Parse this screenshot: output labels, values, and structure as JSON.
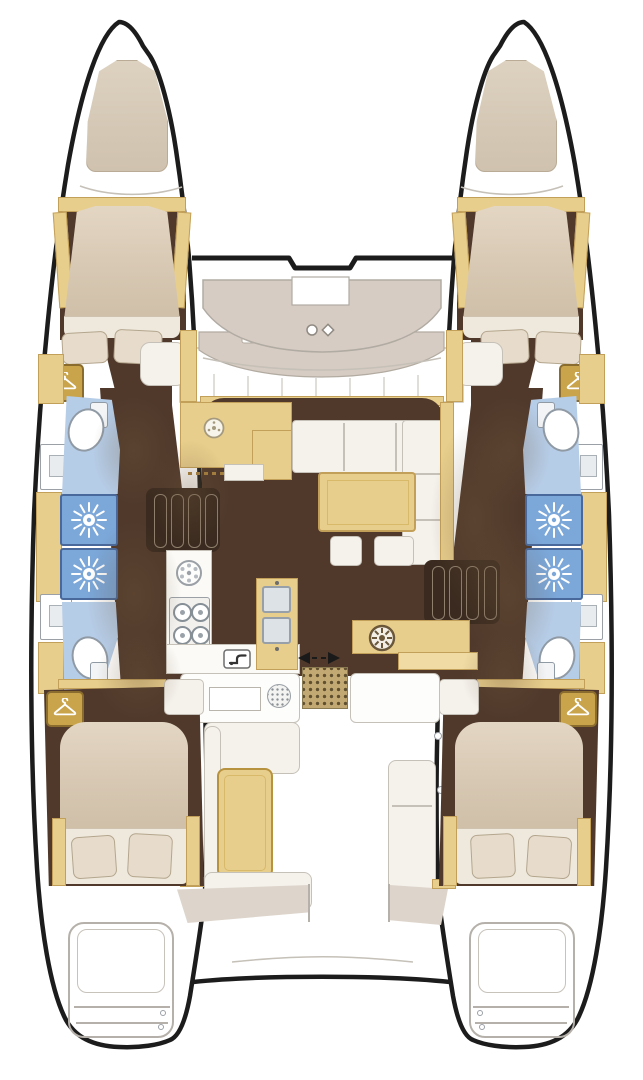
{
  "colors": {
    "bgWhite": "#ffffff",
    "outline": "#1c1c1c",
    "yellow": "#e8ce8c",
    "yellowBorder": "#c2a05a",
    "yellowLight": "#f0dba4",
    "wood": "#50392b",
    "woodDark": "#3a2a1f",
    "blueFloor": "#b6cde8",
    "showerBlue": "#7ba7d9",
    "showerBorder": "#49699c",
    "bedBeige": "#d7c8b3",
    "bedSheet": "#efe9dd",
    "pillow": "#e7dccb",
    "pillowBorder": "#b4a68e",
    "deckBeige": "#d7ccc3",
    "deckBeigeBorder": "#b2aba1",
    "seatWhite": "#f5f2ec",
    "seatBorder": "#c6c1b8",
    "grayLine": "#b5b1aa",
    "grate": "#c2a974",
    "grateDot": "#60502f",
    "benchBeige": "#ddd5cc",
    "basin": "#dde2e6",
    "basinBorder": "#97a0a8",
    "gold": "#c9a44b",
    "goldBorder": "#8a6d2e"
  },
  "fixtures": {
    "hull": "Catamaran hull",
    "forepeak_locker": "Forepeak locker cushion",
    "anchor_locker": "Anchor locker",
    "windlass": "Windlass fitting",
    "foredeck": "Foredeck structure",
    "windshield": "Salon windshield",
    "skylight": "Skylight window",
    "side_deck_pod": "Side deck locker",
    "bulkhead": "Forward bulkhead",
    "v_berth": "Forward cabin double berth",
    "double_bed": "Aft cabin double bed",
    "pillow": "Pillow",
    "wardrobe": "Hanging locker",
    "toilet": "Toilet",
    "washbasin": "Washbasin",
    "shower": "Shower with jets",
    "companionway_steps": "Companionway steps",
    "chart_table": "Forward galley counter",
    "round_sink": "Round sink",
    "galley_counter": "Galley worktop",
    "stove": "Four-burner stove",
    "double_sink": "Double sink",
    "faucet": "Faucet",
    "salon_sofa": "Salon sofa",
    "salon_table": "Salon table",
    "ottoman": "Ottoman stool",
    "wet_bar": "Aft wet bar with sink",
    "sliding_door": "Sliding door track",
    "cockpit_grating": "Cockpit teak grating",
    "cockpit_counter": "Cockpit counter",
    "drawer": "Drawer front",
    "speaker": "Speaker grille",
    "cockpit_bench": "Cockpit bench seat",
    "cockpit_table": "Cockpit table",
    "cockpit_module": "Starboard cockpit module",
    "aft_bench": "Aft cockpit bench",
    "swim_platform": "Transom swim steps",
    "shadow": "Cast shadow"
  },
  "icons": {
    "sun": "shower-jets-icon",
    "hanger": "clothes-hanger-icon",
    "spoke_sink": "round-sink-icon",
    "burner": "stove-burner-icon",
    "faucet": "faucet-icon",
    "door_arrows": "sliding-door-arrows-icon"
  }
}
